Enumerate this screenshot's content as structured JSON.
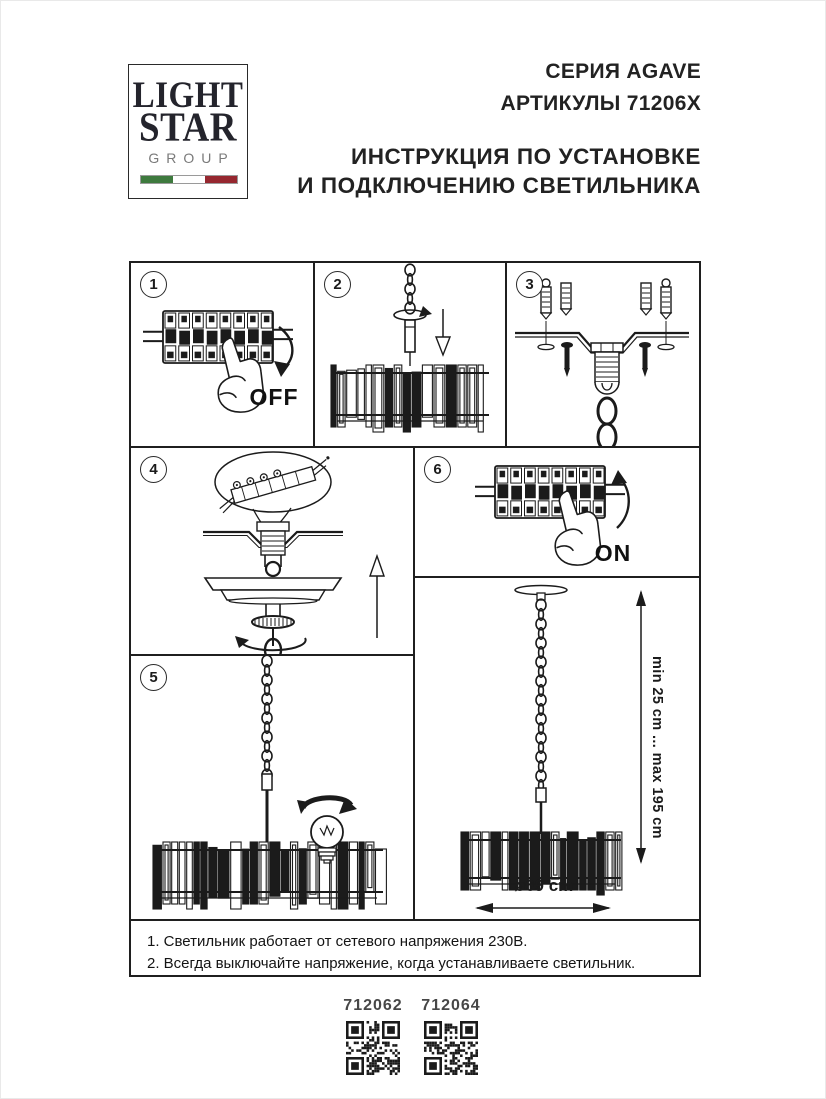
{
  "logo": {
    "line1": "LIGHT",
    "line2": "STAR",
    "line3": "GROUP",
    "flag_colors": {
      "green": "#3e7a3e",
      "white": "#ffffff",
      "red": "#96272f"
    }
  },
  "header": {
    "series": "СЕРИЯ AGAVE",
    "articles": "АРТИКУЛЫ 71206X",
    "title_line1": "ИНСТРУКЦИЯ ПО УСТАНОВКЕ",
    "title_line2": "И ПОДКЛЮЧЕНИЮ СВЕТИЛЬНИКА"
  },
  "steps": {
    "s1": {
      "number": "1",
      "label": "OFF"
    },
    "s2": {
      "number": "2"
    },
    "s3": {
      "number": "3"
    },
    "s4": {
      "number": "4"
    },
    "s5": {
      "number": "5"
    },
    "s6": {
      "number": "6",
      "label": "ON"
    }
  },
  "dimensions": {
    "height_range": "min 25 cm ... max 195 cm",
    "diameter": "ø69 cm"
  },
  "notes": {
    "line1": "1. Светильник работает от сетевого напряжения 230В.",
    "line2": "2. Всегда выключайте напряжение, когда устанавливаете светильник."
  },
  "qr": [
    {
      "label": "712062"
    },
    {
      "label": "712064"
    }
  ],
  "colors": {
    "ink": "#1b1b1b"
  }
}
